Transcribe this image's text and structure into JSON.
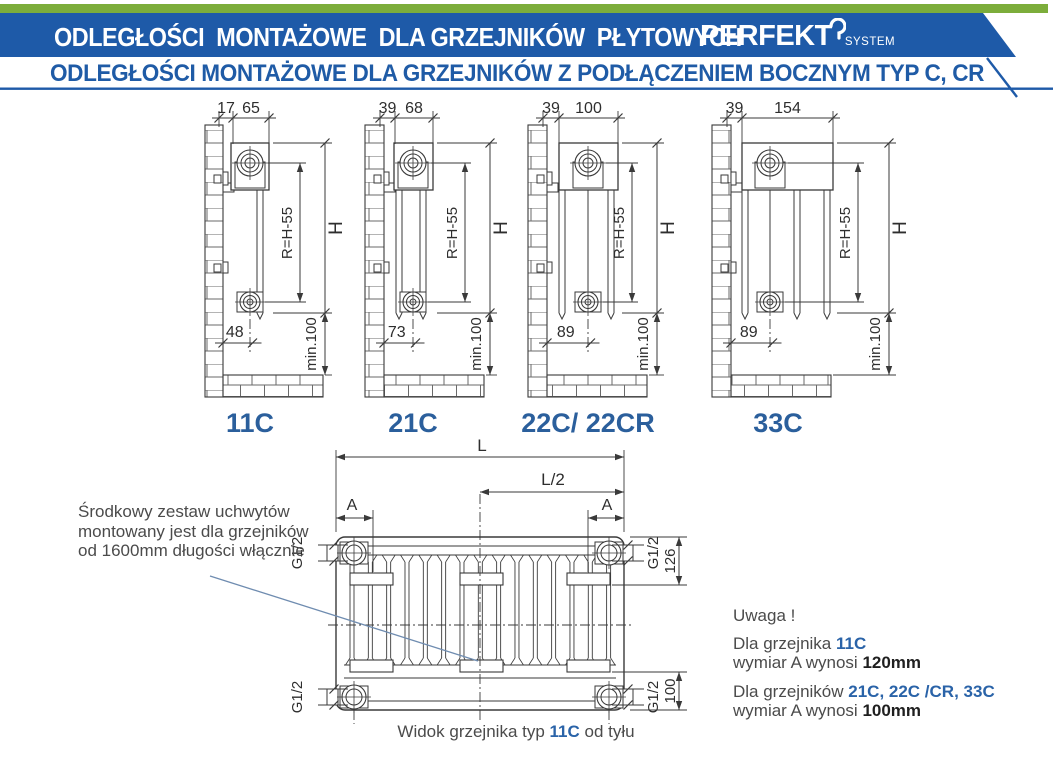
{
  "header": {
    "title": "ODLEGŁOŚCI  MONTAŻOWE  DLA GRZEJNIKÓW  PŁYTOWYCH",
    "logo": {
      "brand": "PERFEKT",
      "sub": "SYSTEM"
    },
    "subtitle": "ODLEGŁOŚCI MONTAŻOWE DLA GRZEJNIKÓW Z PODŁĄCZENIEM BOCZNYM TYP C, CR",
    "colors": {
      "green": "#7cad3b",
      "blue": "#1e5aa8",
      "label_blue": "#2b5f9c",
      "line": "#3a3a3a",
      "leader": "#6f8cb0"
    }
  },
  "diagrams": [
    {
      "label": "11C",
      "dim_wall_gap": "17",
      "dim_depth": "65",
      "dim_bottom": "48",
      "dim_radius": "R=H-55",
      "dim_height": "H",
      "dim_floor": "min.100"
    },
    {
      "label": "21C",
      "dim_wall_gap": "39",
      "dim_depth": "68",
      "dim_bottom": "73",
      "dim_radius": "R=H-55",
      "dim_height": "H",
      "dim_floor": "min.100"
    },
    {
      "label": "22C/ 22CR",
      "dim_wall_gap": "39",
      "dim_depth": "100",
      "dim_bottom": "89",
      "dim_radius": "R=H-55",
      "dim_height": "H",
      "dim_floor": "min.100"
    },
    {
      "label": "33C",
      "dim_wall_gap": "39",
      "dim_depth": "154",
      "dim_bottom": "89",
      "dim_radius": "R=H-55",
      "dim_height": "H",
      "dim_floor": "min.100"
    }
  ],
  "rear_view": {
    "dims": {
      "length": "L",
      "half_length": "L/2",
      "bracket_offset_left": "A",
      "bracket_offset_right": "A",
      "thread": "G1/2",
      "top_offset": "126",
      "bottom_offset": "100"
    },
    "caption": {
      "prefix": "Widok grzejnika typ ",
      "type": "11C",
      "suffix": " od tyłu"
    }
  },
  "notes": {
    "left": {
      "lines": [
        "Środkowy zestaw uchwytów",
        "montowany jest dla grzejników",
        "od 1600mm długości włącznie"
      ]
    },
    "right": {
      "title": "Uwaga !",
      "item1_prefix": "Dla grzejnika ",
      "item1_types": "11C",
      "item1_line2_prefix": "wymiar A wynosi ",
      "item1_value": "120mm",
      "item2_prefix": "Dla grzejników ",
      "item2_types": "21C, 22C /CR, 33C",
      "item2_line2_prefix": "wymiar A wynosi ",
      "item2_value": "100mm"
    }
  }
}
